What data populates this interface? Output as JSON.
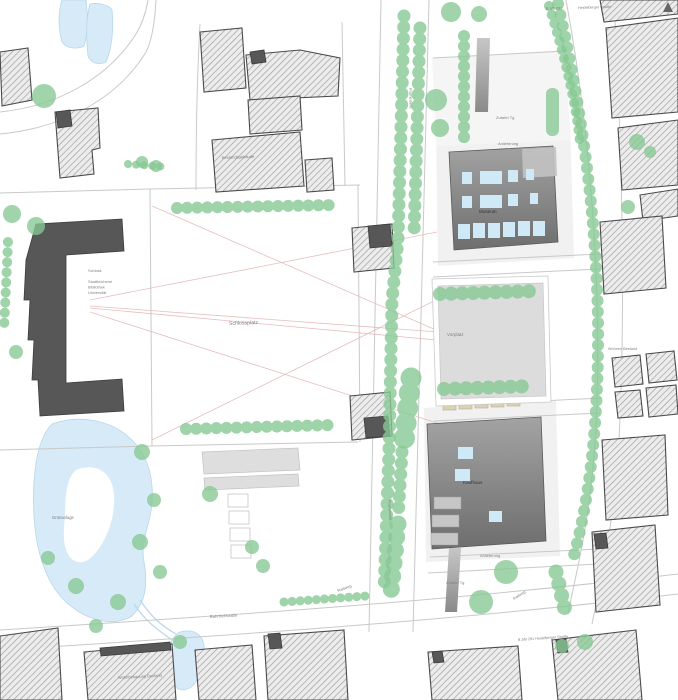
{
  "labels": {
    "schlossplatz": "Schlossplatz",
    "museum": "Museum",
    "vorplatz": "Vorplatz",
    "kaufhaus": "Kaufhaus",
    "schloss1": "Schloss",
    "schloss2": "Stadtbücherei",
    "schloss3": "Bibliothek",
    "schloss4": "Universität",
    "rathaus": "Bestandsgebäude",
    "zufahrt_tg_top": "Zufahrt Tg",
    "anlieferung_top": "Anlieferung",
    "anlieferung_bottom": "Anlieferung",
    "zufahrt_tg_bottom": "Zufahrt Tg",
    "radweg_ost": "Radweg",
    "radweg_sued": "Radweg",
    "gruenanlage": "Grünanlage",
    "bahnhofstrasse": "Bahnhofstraße",
    "promenade": "Promenade",
    "promenade_sued": "Promenade",
    "b291_nord": "B 3/B 291",
    "heidelberger_nord": "Heidelberger Straße",
    "b291_sued": "B 3/B 291 Heidelberger Straße",
    "wohnen_bestand": "Wohnbebauung Bestand",
    "wohnen_ost": "Wohnen Bestand"
  },
  "colors": {
    "tree": "#87c893",
    "water": "#d6eaf7",
    "existing_building_hatch": "#9b9b9b",
    "proposed_building_top": "#a3a3a3",
    "proposed_building_bottom": "#6e6e6e",
    "window": "#cfe9f7",
    "sightline": "#e3b7b7",
    "plaza": "#dcdcdc",
    "stall": "#d9d3b4"
  }
}
